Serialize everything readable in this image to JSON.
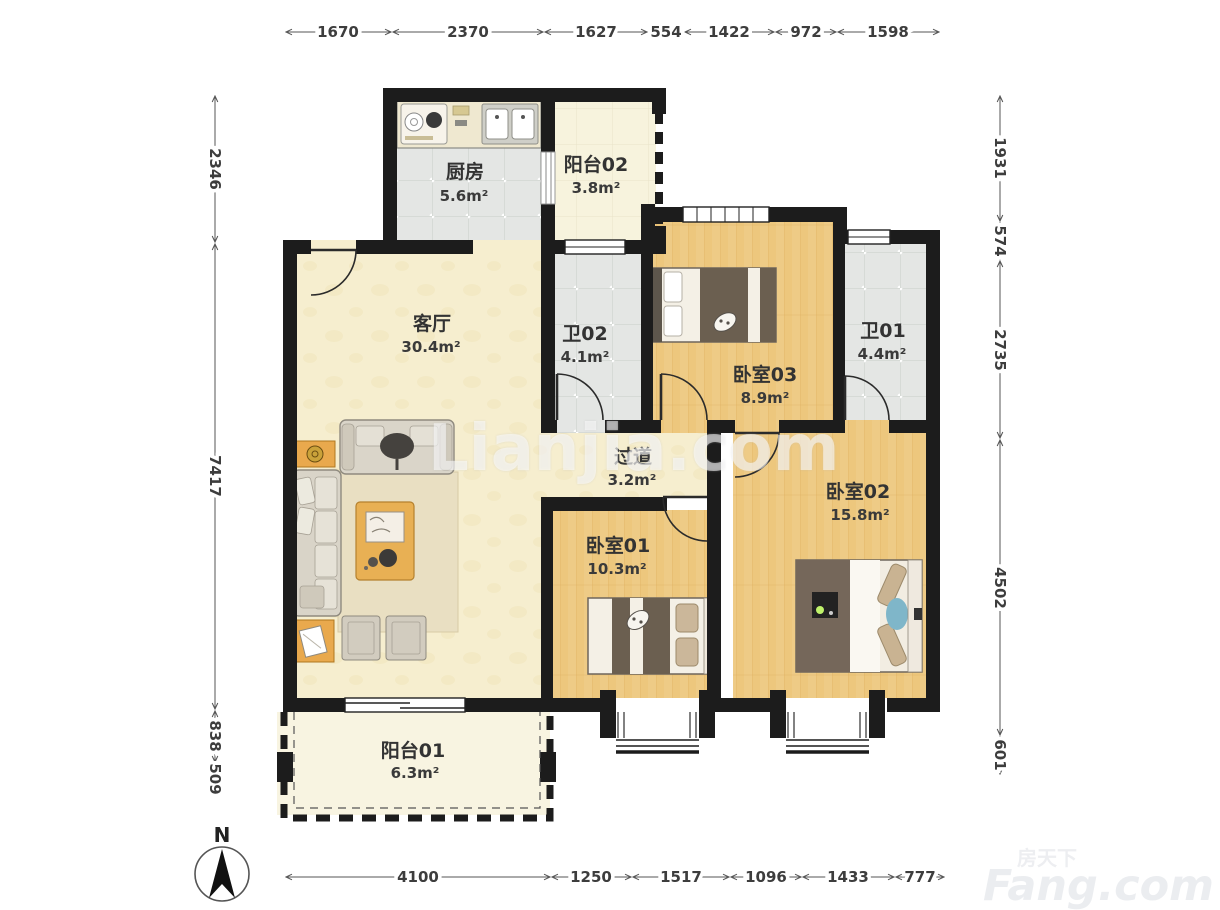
{
  "meta": {
    "north_label": "N",
    "type": "floorplan"
  },
  "watermarks": {
    "center": "Lianjia.com",
    "brand_cn": "房天下",
    "brand_en": "Fang.com"
  },
  "dimensions": {
    "top": [
      1670,
      2370,
      1627,
      554,
      1422,
      972,
      1598
    ],
    "bottom": [
      4100,
      1250,
      1517,
      1096,
      1433,
      777
    ],
    "left": [
      2346,
      7417,
      838,
      509
    ],
    "right": [
      1931,
      574,
      2735,
      4502,
      601
    ]
  },
  "rooms": [
    {
      "id": "kitchen",
      "name": "厨房",
      "area": "5.6m²"
    },
    {
      "id": "balcony02",
      "name": "阳台02",
      "area": "3.8m²"
    },
    {
      "id": "living",
      "name": "客厅",
      "area": "30.4m²"
    },
    {
      "id": "bath02",
      "name": "卫02",
      "area": "4.1m²"
    },
    {
      "id": "bedroom03",
      "name": "卧室03",
      "area": "8.9m²"
    },
    {
      "id": "bath01",
      "name": "卫01",
      "area": "4.4m²"
    },
    {
      "id": "hallway",
      "name": "过道",
      "area": "3.2m²"
    },
    {
      "id": "bedroom01",
      "name": "卧室01",
      "area": "10.3m²"
    },
    {
      "id": "bedroom02",
      "name": "卧室02",
      "area": "15.8m²"
    },
    {
      "id": "balcony01",
      "name": "阳台01",
      "area": "6.3m²"
    }
  ],
  "colors": {
    "wall": "#1c1c1c",
    "dim_line": "#555555",
    "label_text": "#333333",
    "floor_cream": "#f6eecf",
    "floor_wood": "#edc77d",
    "floor_tile": "#e4e6e4",
    "floor_balcony": "#f8f4e1",
    "furniture_accent": "#e8ad52",
    "watermark": "#eef0f4"
  }
}
